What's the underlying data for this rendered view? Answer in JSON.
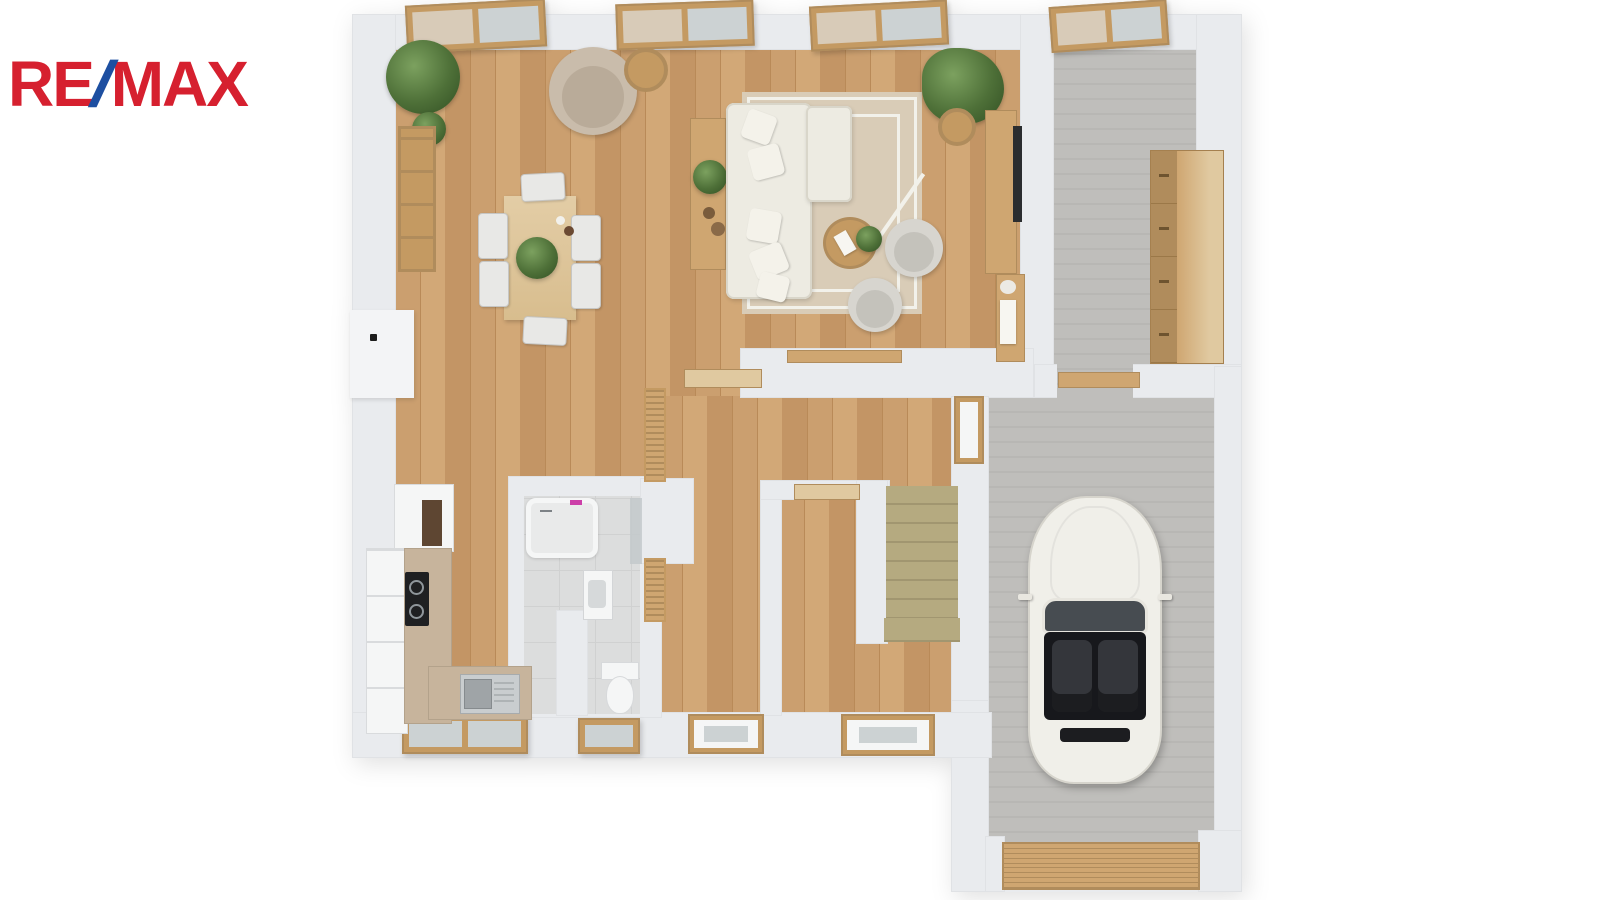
{
  "logo": {
    "re": "RE",
    "slash": "/",
    "max": "MAX"
  },
  "colors": {
    "logo_red": "#d6202f",
    "logo_blue": "#1d4fa1",
    "wall": "#e9ebee",
    "wall_bright": "#f3f4f6",
    "wood_a": "#cb9f6f",
    "wood_b": "#c39565",
    "wood_c": "#d2a877",
    "wood_line": "#b98a58",
    "wood_frame": "#c49a62",
    "wood_furn": "#cfa671",
    "wood_furn_dark": "#b08c5c",
    "wood_light": "#e0c9a0",
    "gray_a": "#bfbebb",
    "gray_b": "#b8b7b4",
    "tile": "#dcdddd",
    "tile_line": "#d0d1d1",
    "stair": "#b5aa80",
    "stair_dark": "#a19670",
    "sofa": "#edebe2",
    "sofa_shadow": "#d9d6ca",
    "rug": "#d9ccb7",
    "rug_line": "#f2f1ea",
    "green": "#4e7038",
    "green_light": "#7ca15f",
    "green_dark": "#3b5a2a",
    "chair_gray": "#d7d5cf",
    "chair_inner": "#c4c2bb",
    "car_body": "#f0efe9",
    "car_shadow": "#d6d4cc",
    "car_glass": "#474c51",
    "car_seat": "#17181c",
    "car_seat_light": "#34363b",
    "glass": "#ccd2d3",
    "curtain": "#d8cbb8",
    "white_fix": "#f5f6f6",
    "black_appliance": "#1f2022"
  },
  "counts": {
    "stair_steps": 8,
    "garage_slats": 9,
    "wardrobe_drawers": 4
  }
}
